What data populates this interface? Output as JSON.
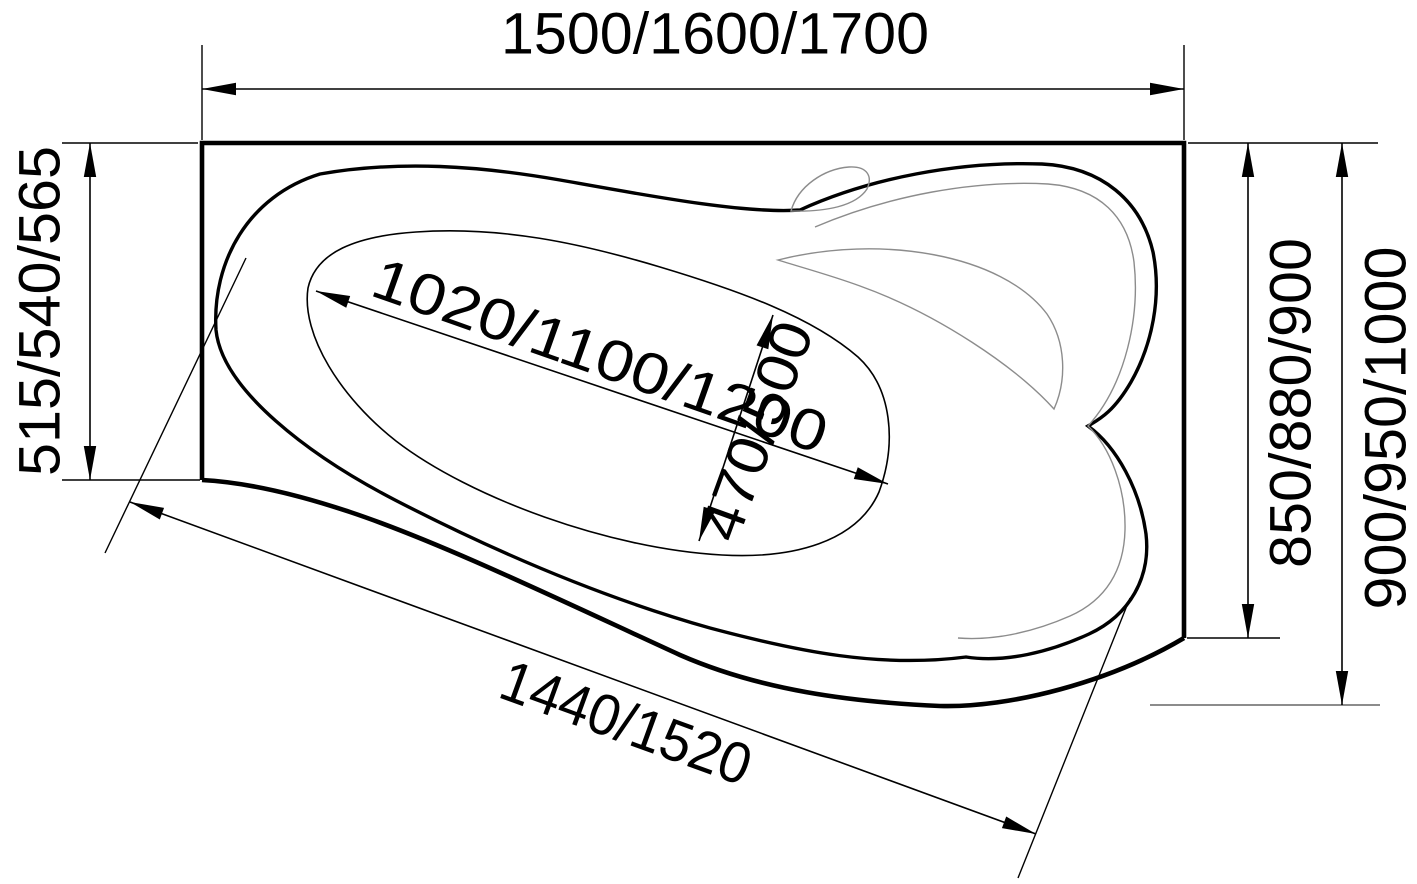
{
  "drawing": {
    "title": "Asymmetric corner bathtub — dimensional top view",
    "units": "mm",
    "background_color": "#ffffff",
    "line_color": "#000000",
    "contour_color": "#8c8c8c",
    "dimensions": {
      "overall_length": {
        "label": "1500/1600/1700",
        "location": "top edge",
        "values_mm": [
          1500,
          1600,
          1700
        ]
      },
      "left_end_width": {
        "label": "515/540/565",
        "location": "left edge",
        "values_mm": [
          515,
          540,
          565
        ]
      },
      "right_side_depth": {
        "label": "850/880/900",
        "location": "right edge inner",
        "values_mm": [
          850,
          880,
          900
        ]
      },
      "overall_width": {
        "label": "900/950/1000",
        "location": "right edge overall",
        "values_mm": [
          900,
          950,
          1000
        ]
      },
      "basin_length": {
        "label": "1020/1100/1200",
        "location": "inner basin diagonal",
        "values_mm": [
          1020,
          1100,
          1200
        ]
      },
      "basin_width": {
        "label": "470/500",
        "location": "inner basin cross",
        "values_mm": [
          470,
          500
        ]
      },
      "front_edge_length": {
        "label": "1440/1520",
        "location": "front apron diagonal",
        "values_mm": [
          1440,
          1520
        ]
      }
    }
  }
}
